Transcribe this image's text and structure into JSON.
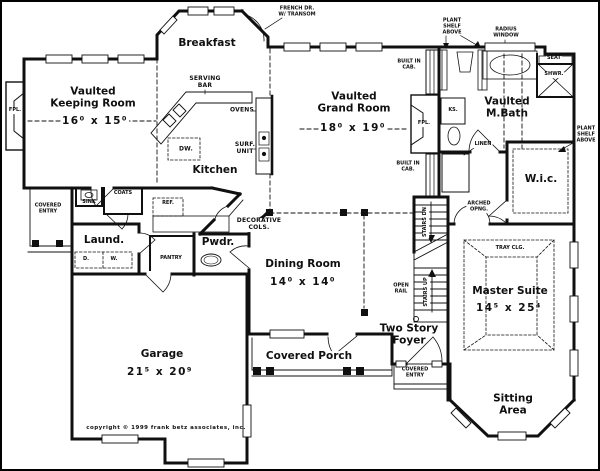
{
  "plan": {
    "copyright": "copyright © 1999 frank betz associates, inc.",
    "colors": {
      "ink": "#101010",
      "background": "#ffffff"
    },
    "rooms": {
      "keeping": {
        "name": "Vaulted\nKeeping Room",
        "dims": "16⁰ x 15⁰"
      },
      "breakfast": {
        "name": "Breakfast"
      },
      "kitchen": {
        "name": "Kitchen"
      },
      "grand": {
        "name": "Vaulted\nGrand Room",
        "dims": "18⁰ x 19⁰"
      },
      "mbath": {
        "name": "Vaulted\nM.Bath"
      },
      "wic": {
        "name": "W.i.c."
      },
      "laundry": {
        "name": "Laund."
      },
      "pwdr": {
        "name": "Pwdr."
      },
      "dining": {
        "name": "Dining Room",
        "dims": "14⁰ x 14⁰"
      },
      "garage": {
        "name": "Garage",
        "dims": "21⁵ x 20⁹"
      },
      "foyer": {
        "name": "Two Story\nFoyer"
      },
      "master": {
        "name": "Master Suite",
        "dims": "14⁵ x 25⁴"
      },
      "sitting": {
        "name": "Sitting\nArea"
      },
      "porch": {
        "name": "Covered Porch"
      }
    },
    "annotations": {
      "french_door": "FRENCH DR.\nW/ TRANSOM",
      "serving_bar": "SERVING\nBAR",
      "ovens": "OVENS",
      "surf_unit": "SURF.\nUNIT",
      "dw": "DW.",
      "ref": "REF.",
      "sink": "SINK",
      "coats": "COATS",
      "covered_entry_left": "COVERED\nENTRY",
      "covered_entry_front": "COVERED\nENTRY",
      "fpl_left": "FPL.",
      "fpl_right": "FPL.",
      "dryer": "D.",
      "washer": "W.",
      "pantry": "PANTRY",
      "decorative_cols": "DECORATIVE\nCOLS.",
      "open_rail": "OPEN\nRAIL",
      "stairs_dn": "STAIRS DN",
      "stairs_up": "STAIRS UP",
      "arched_opng": "ARCHED\nOPNG.",
      "built_in_cab_top": "BUILT IN\nCAB.",
      "built_in_cab_bottom": "BUILT IN\nCAB.",
      "ks": "KS.",
      "linen": "LINEN",
      "plant_shelf_top": "PLANT\nSHELF\nABOVE",
      "plant_shelf_right": "PLANT\nSHELF\nABOVE",
      "radius_window": "RADIUS\nWINDOW",
      "seat": "SEAT",
      "shwr": "SHWR.",
      "tray_clg": "TRAY CLG."
    }
  }
}
